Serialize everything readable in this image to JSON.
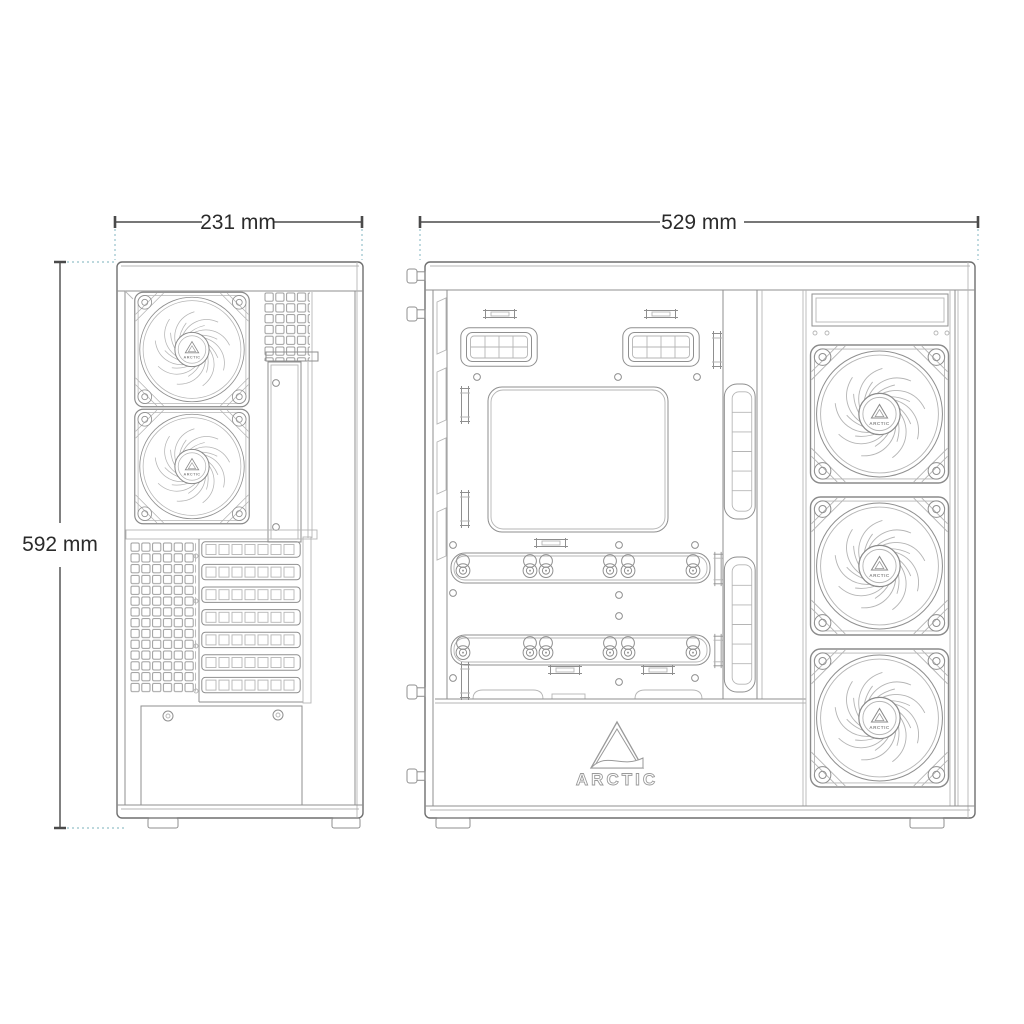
{
  "page": {
    "background_color": "#ffffff"
  },
  "dimensions": {
    "width": {
      "label": "231 mm"
    },
    "depth": {
      "label": "529 mm"
    },
    "height": {
      "label": "592 mm"
    }
  },
  "brand": {
    "shroud_label": "ARCTIC",
    "fan_hub_label": "ARCTIC"
  },
  "views": {
    "rear": {
      "fans_visible": 2,
      "expansion_slots": 7
    },
    "side": {
      "fans_visible": 3
    }
  },
  "colors": {
    "line": "#8f8f8f",
    "line_dark": "#6f6f6f",
    "line_light": "#b5b5b5",
    "dimension_line": "#4a4a4a",
    "dimension_text": "#2b2b2b",
    "extension_line": "#a6cbd2"
  }
}
